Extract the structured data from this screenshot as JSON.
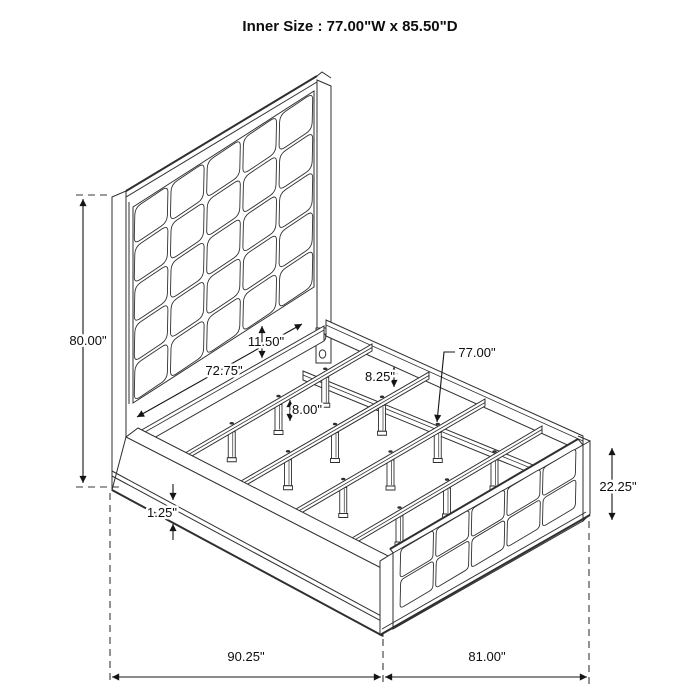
{
  "title": "Inner Size : 77.00\"W x 85.50\"D",
  "dims": {
    "headboard_height": "80.00\"",
    "slat_span": "72.75\"",
    "headboard_to_rail_gap": "11.50\"",
    "rail_height": "8.25\"",
    "slat_leg_height": "8.00\"",
    "slat_length": "77.00\"",
    "side_rail_trim": "1.25\"",
    "footboard_height": "22.25\"",
    "overall_depth": "90.25\"",
    "overall_width": "81.00\""
  },
  "colors": {
    "line": "#2f2f2f",
    "dimension": "#141414",
    "background": "#ffffff"
  }
}
